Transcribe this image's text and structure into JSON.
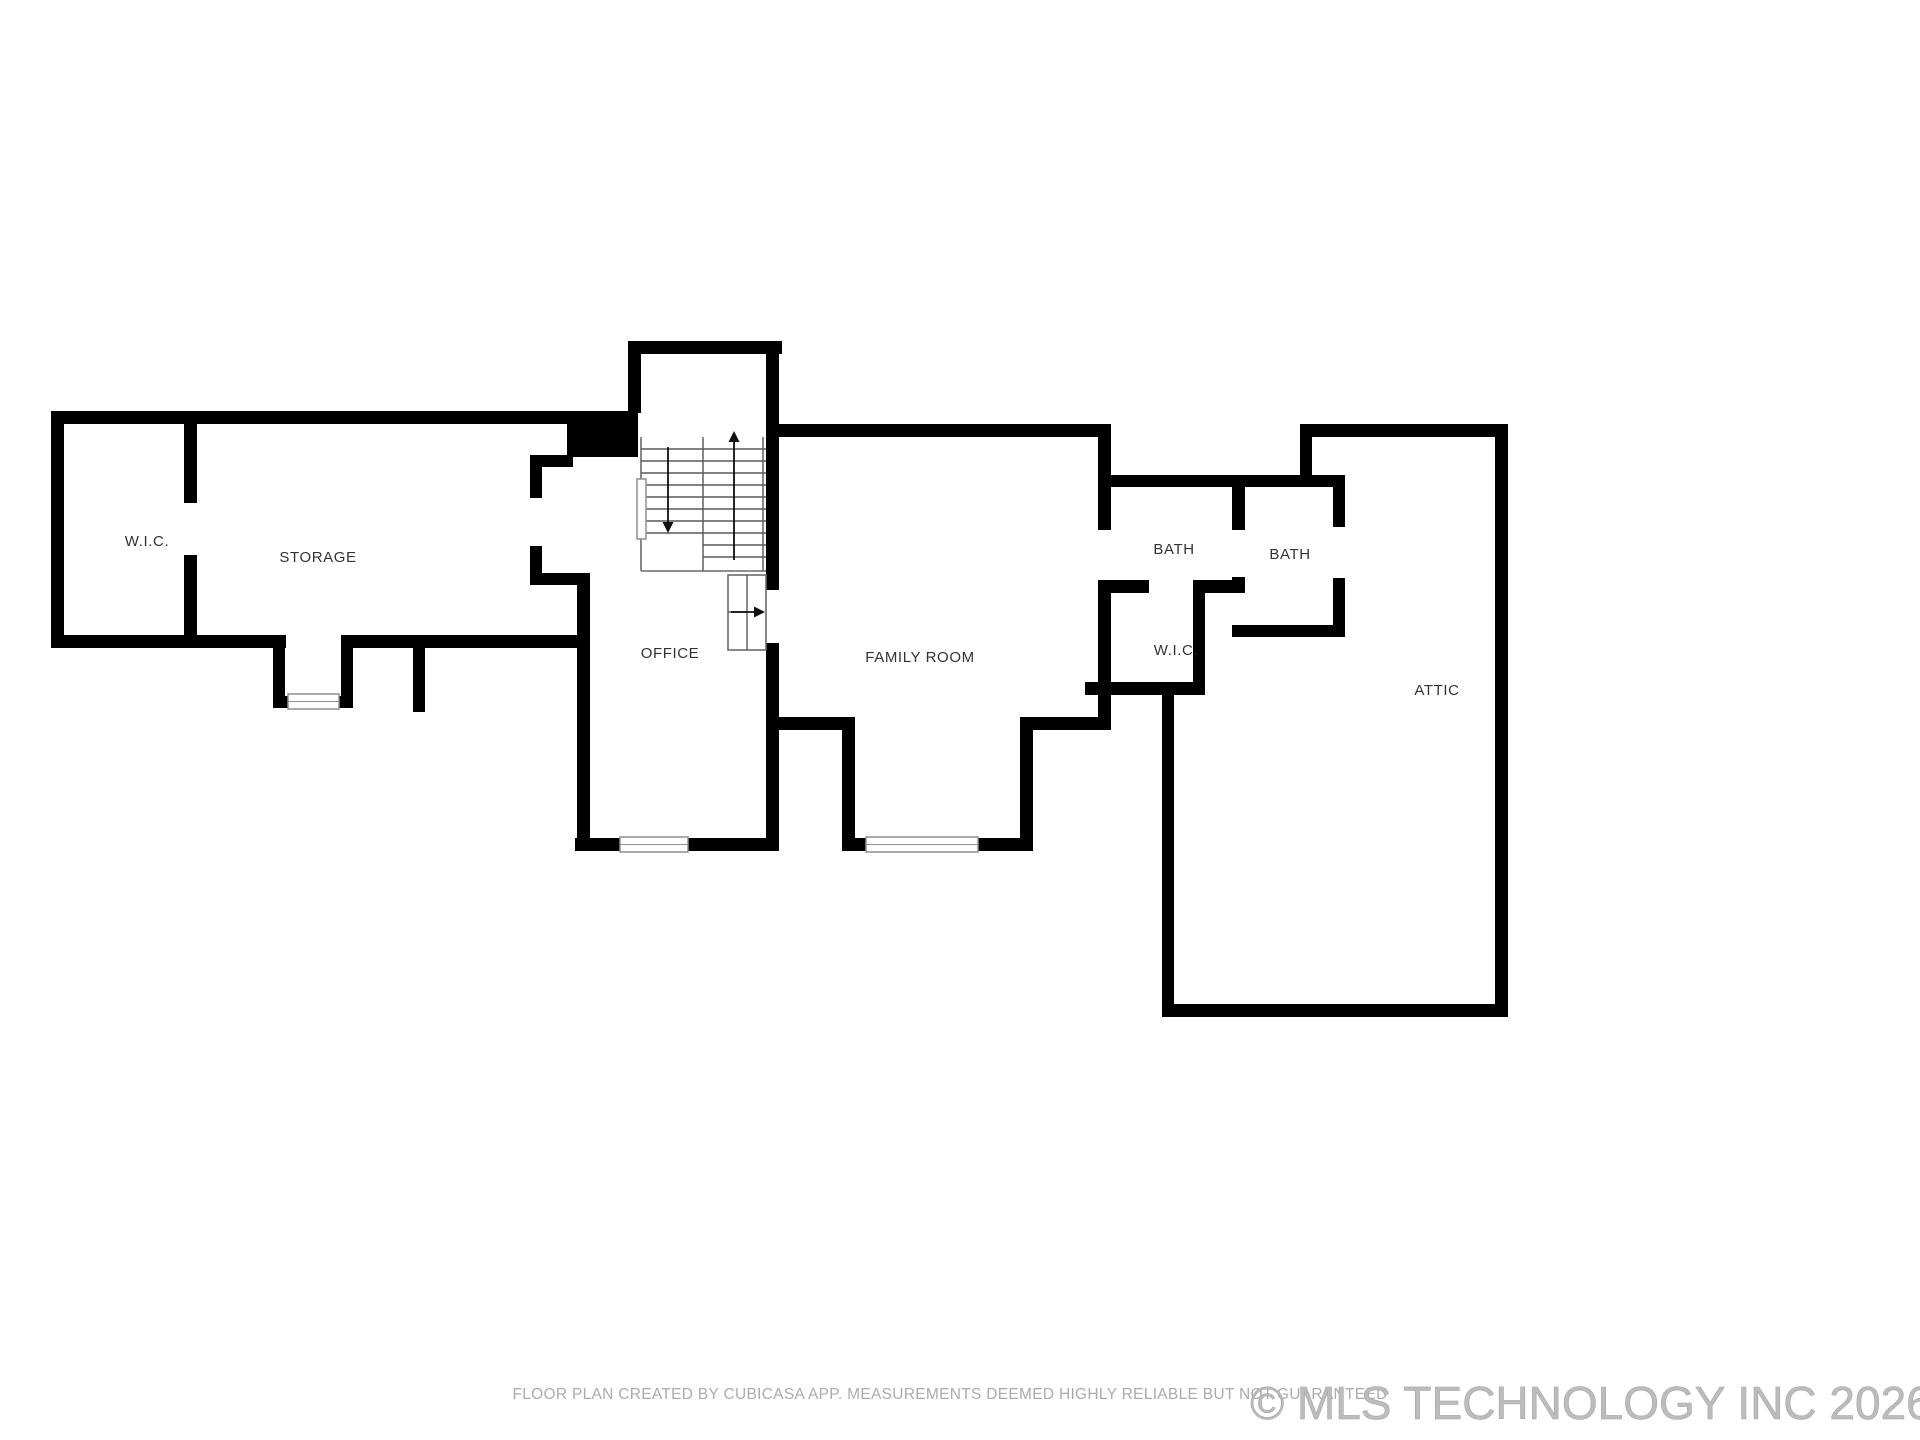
{
  "document": {
    "type": "floor-plan",
    "background": "#ffffff"
  },
  "rooms": [
    {
      "id": "wic-left",
      "label": "W.I.C."
    },
    {
      "id": "storage",
      "label": "STORAGE"
    },
    {
      "id": "office",
      "label": "OFFICE"
    },
    {
      "id": "family-room",
      "label": "FAMILY ROOM"
    },
    {
      "id": "bath-left",
      "label": "BATH"
    },
    {
      "id": "bath-right",
      "label": "BATH"
    },
    {
      "id": "wic-right",
      "label": "W.I.C."
    },
    {
      "id": "attic",
      "label": "ATTIC"
    }
  ],
  "stairs": {
    "up_arrow": "up",
    "down_arrow": "down",
    "exit_arrow": "right"
  },
  "footer": {
    "disclaimer": "FLOOR PLAN CREATED BY CUBICASA APP. MEASUREMENTS DEEMED HIGHLY RELIABLE BUT NOT GUARANTEED",
    "watermark": "© MLS TECHNOLOGY INC 2026"
  },
  "colors": {
    "wall": "#000000",
    "room_label": "#333333",
    "stair_line": "#5a5a5a",
    "window_stroke": "#8f8f8f",
    "disclaimer": "#ababab",
    "watermark": "#bcbcbc"
  }
}
